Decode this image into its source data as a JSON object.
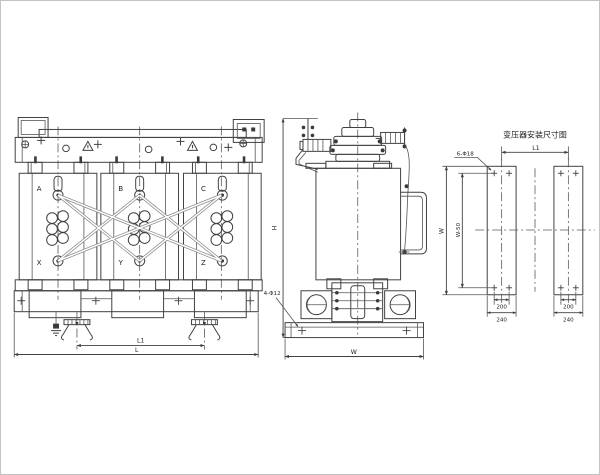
{
  "meta": {
    "background": "#ffffff",
    "line_color": "#414141",
    "frame_color": "#c3c3c3"
  },
  "front_view": {
    "description": "dry-type transformer front elevation",
    "phase_top_labels": [
      "A",
      "B",
      "C"
    ],
    "phase_bottom_labels": [
      "X",
      "Y",
      "Z"
    ],
    "dims": {
      "l1": "L1",
      "l": "L"
    }
  },
  "side_view": {
    "description": "transformer side elevation",
    "dims": {
      "h": "H",
      "w": "W"
    },
    "hole_note": "4-Φ12"
  },
  "install_view": {
    "title": "变压器安装尺寸图",
    "hole_note": "6-Φ18",
    "dims": {
      "l1": "L1",
      "w": "W",
      "w50": "W-50",
      "hole_spacing": "200",
      "rail_width": "240"
    }
  }
}
